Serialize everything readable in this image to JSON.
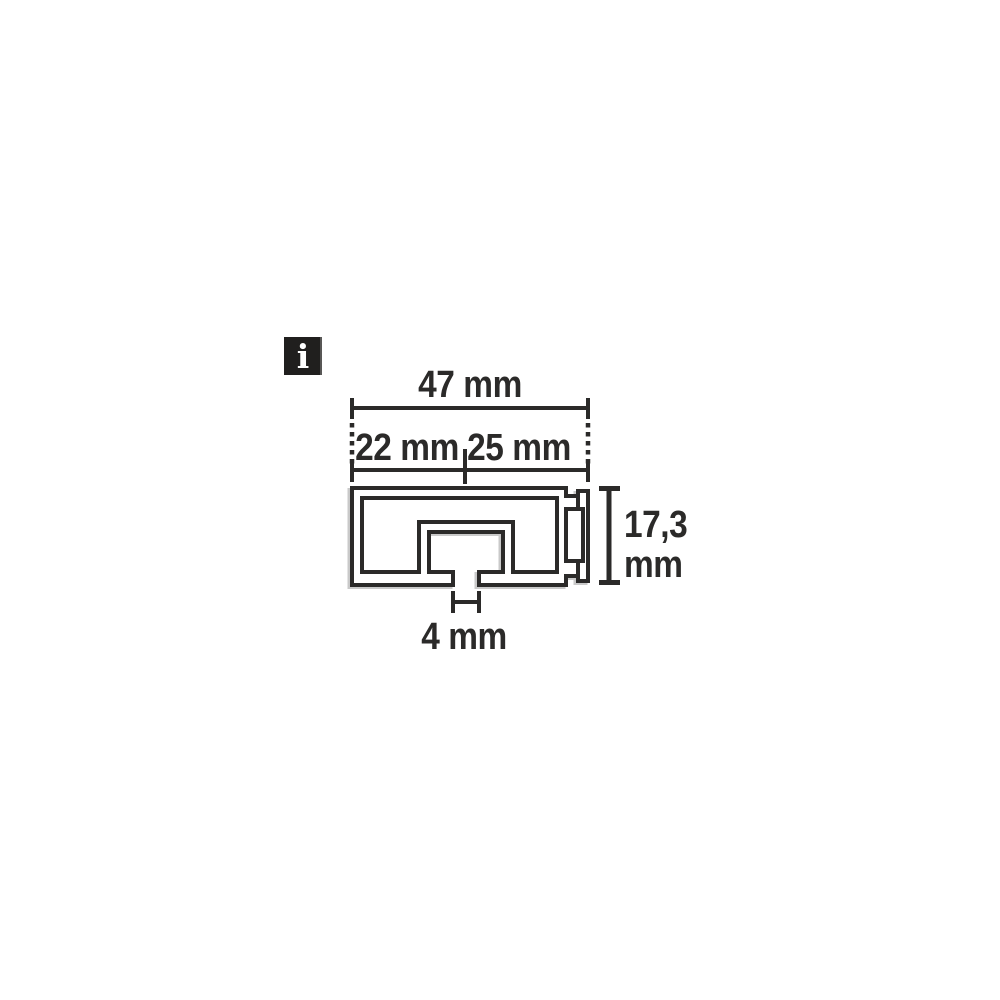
{
  "info_icon": {
    "glyph": "i"
  },
  "diagram": {
    "type": "technical-profile-cross-section",
    "line_color": "#2b2a29",
    "shadow_color": "#c9c9c9",
    "background": "#ffffff",
    "dimensions": {
      "total_width": {
        "label": "47 mm",
        "value": 47,
        "unit": "mm"
      },
      "left_segment": {
        "label": "22 mm",
        "value": 22,
        "unit": "mm"
      },
      "right_segment": {
        "label": "25 mm",
        "value": 25,
        "unit": "mm"
      },
      "height_line1": "17,3",
      "height_line2": "mm",
      "height_value": 17.3,
      "slot_width": {
        "label": "4 mm",
        "value": 4,
        "unit": "mm"
      }
    }
  }
}
